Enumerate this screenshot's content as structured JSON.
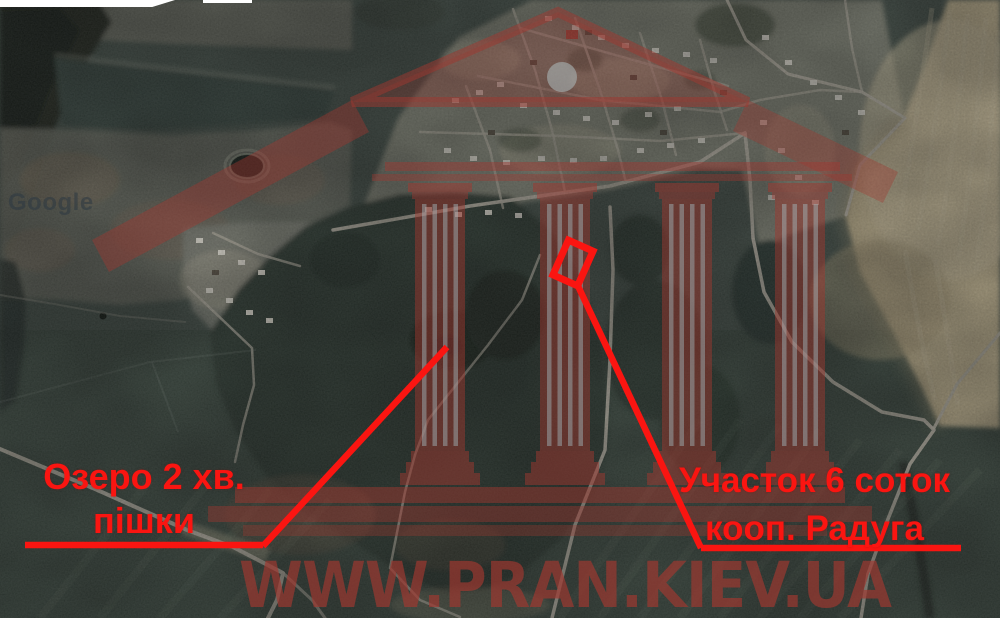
{
  "map": {
    "type": "satellite",
    "attribution": "Google",
    "annotation_color": "#fa1511",
    "labels": {
      "lake": {
        "line1": "Озеро 2 хв.",
        "line2": "пішки"
      },
      "plot": {
        "line1": "Участок 6 соток",
        "line2": "кооп. Радуга"
      }
    }
  },
  "watermark": {
    "site_text": "WWW.PRAN.KIEV.UA",
    "color": "#a03830"
  }
}
